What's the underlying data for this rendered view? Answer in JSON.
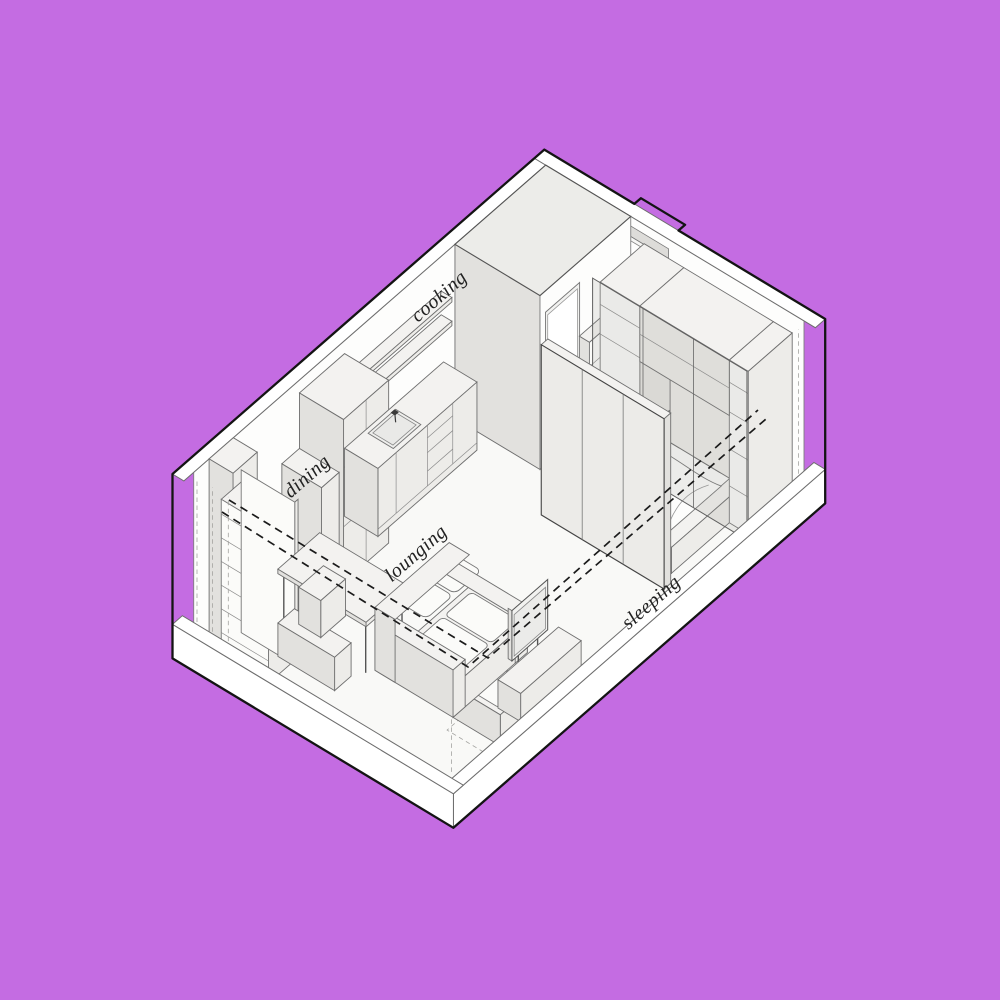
{
  "scene": {
    "type": "axonometric-studio-floor-plan",
    "colors": {
      "background": "#c46ce2",
      "paper": "#ffffff",
      "floor": "#f9f9f7",
      "furniture_top": "#f3f2f0",
      "furniture_front": "#edece9",
      "furniture_side": "#e2e1de",
      "bathroom_roof": "#ecece9",
      "outline": "#141414",
      "line": "#7f7f7f",
      "label_ink": "#222222",
      "dashed_track": "#1b1b1b"
    },
    "areas": [
      "cooking",
      "dining",
      "lounging",
      "sleeping"
    ],
    "labels": {
      "cooking": {
        "text": "cooking"
      },
      "dining": {
        "text": "dining"
      },
      "lounging": {
        "text": "lounging"
      },
      "sleeping": {
        "text": "sleeping"
      }
    }
  }
}
